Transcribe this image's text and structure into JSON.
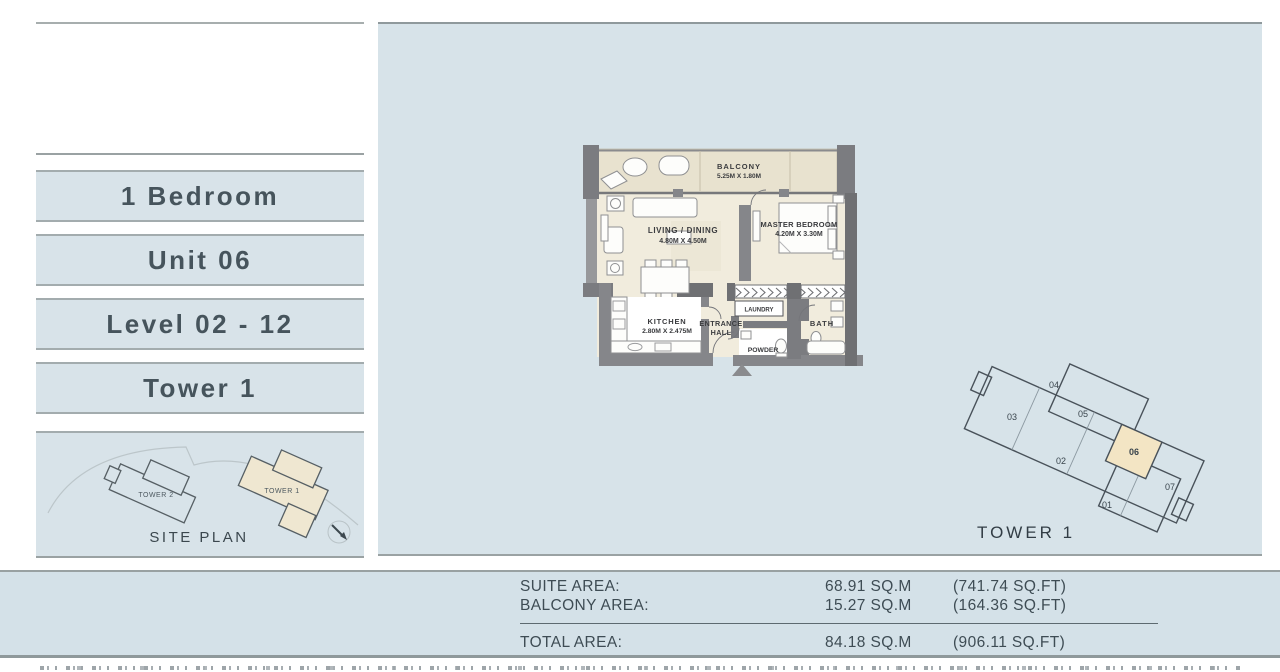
{
  "palette": {
    "page_bg": "#ffffff",
    "panel_blue": "#d7e3e9",
    "box_blue": "#d8e3e9",
    "beige": "#eae3d0",
    "highlight_beige": "#f2e4c3",
    "wall_gray": "#85868a",
    "line_gray": "#9aa2a3",
    "text_dark": "#3e4c54"
  },
  "sidebar": {
    "labels": [
      {
        "label": "1 Bedroom"
      },
      {
        "label": "Unit 06"
      },
      {
        "label": "Level 02 - 12"
      },
      {
        "label": "Tower 1"
      }
    ],
    "siteplan": {
      "tower2_label": "TOWER 2",
      "tower1_label": "TOWER 1",
      "caption": "SITE PLAN"
    }
  },
  "floorplan": {
    "balcony": {
      "name": "BALCONY",
      "dim": "5.25M X 1.80M"
    },
    "living": {
      "name": "LIVING / DINING",
      "dim": "4.80M X 4.50M"
    },
    "master": {
      "name": "MASTER BEDROOM",
      "dim": "4.20M X 3.30M"
    },
    "kitchen": {
      "name": "KITCHEN",
      "dim": "2.80M X 2.475M"
    },
    "entrance_line1": "ENTRANCE",
    "entrance_line2": "HALL",
    "laundry": "LAUNDRY",
    "powder": "POWDER",
    "bath": "BATH"
  },
  "keyplan": {
    "title": "TOWER 1",
    "units": [
      "01",
      "02",
      "03",
      "04",
      "05",
      "06",
      "07"
    ],
    "highlighted_unit": "06"
  },
  "areas": {
    "rows": [
      {
        "label": "SUITE AREA:",
        "sqm": "68.91 SQ.M",
        "sqft": "(741.74 SQ.FT)"
      },
      {
        "label": "BALCONY AREA:",
        "sqm": "15.27 SQ.M",
        "sqft": "(164.36 SQ.FT)"
      }
    ],
    "total": {
      "label": "TOTAL AREA:",
      "sqm": "84.18 SQ.M",
      "sqft": "(906.11 SQ.FT)"
    }
  }
}
